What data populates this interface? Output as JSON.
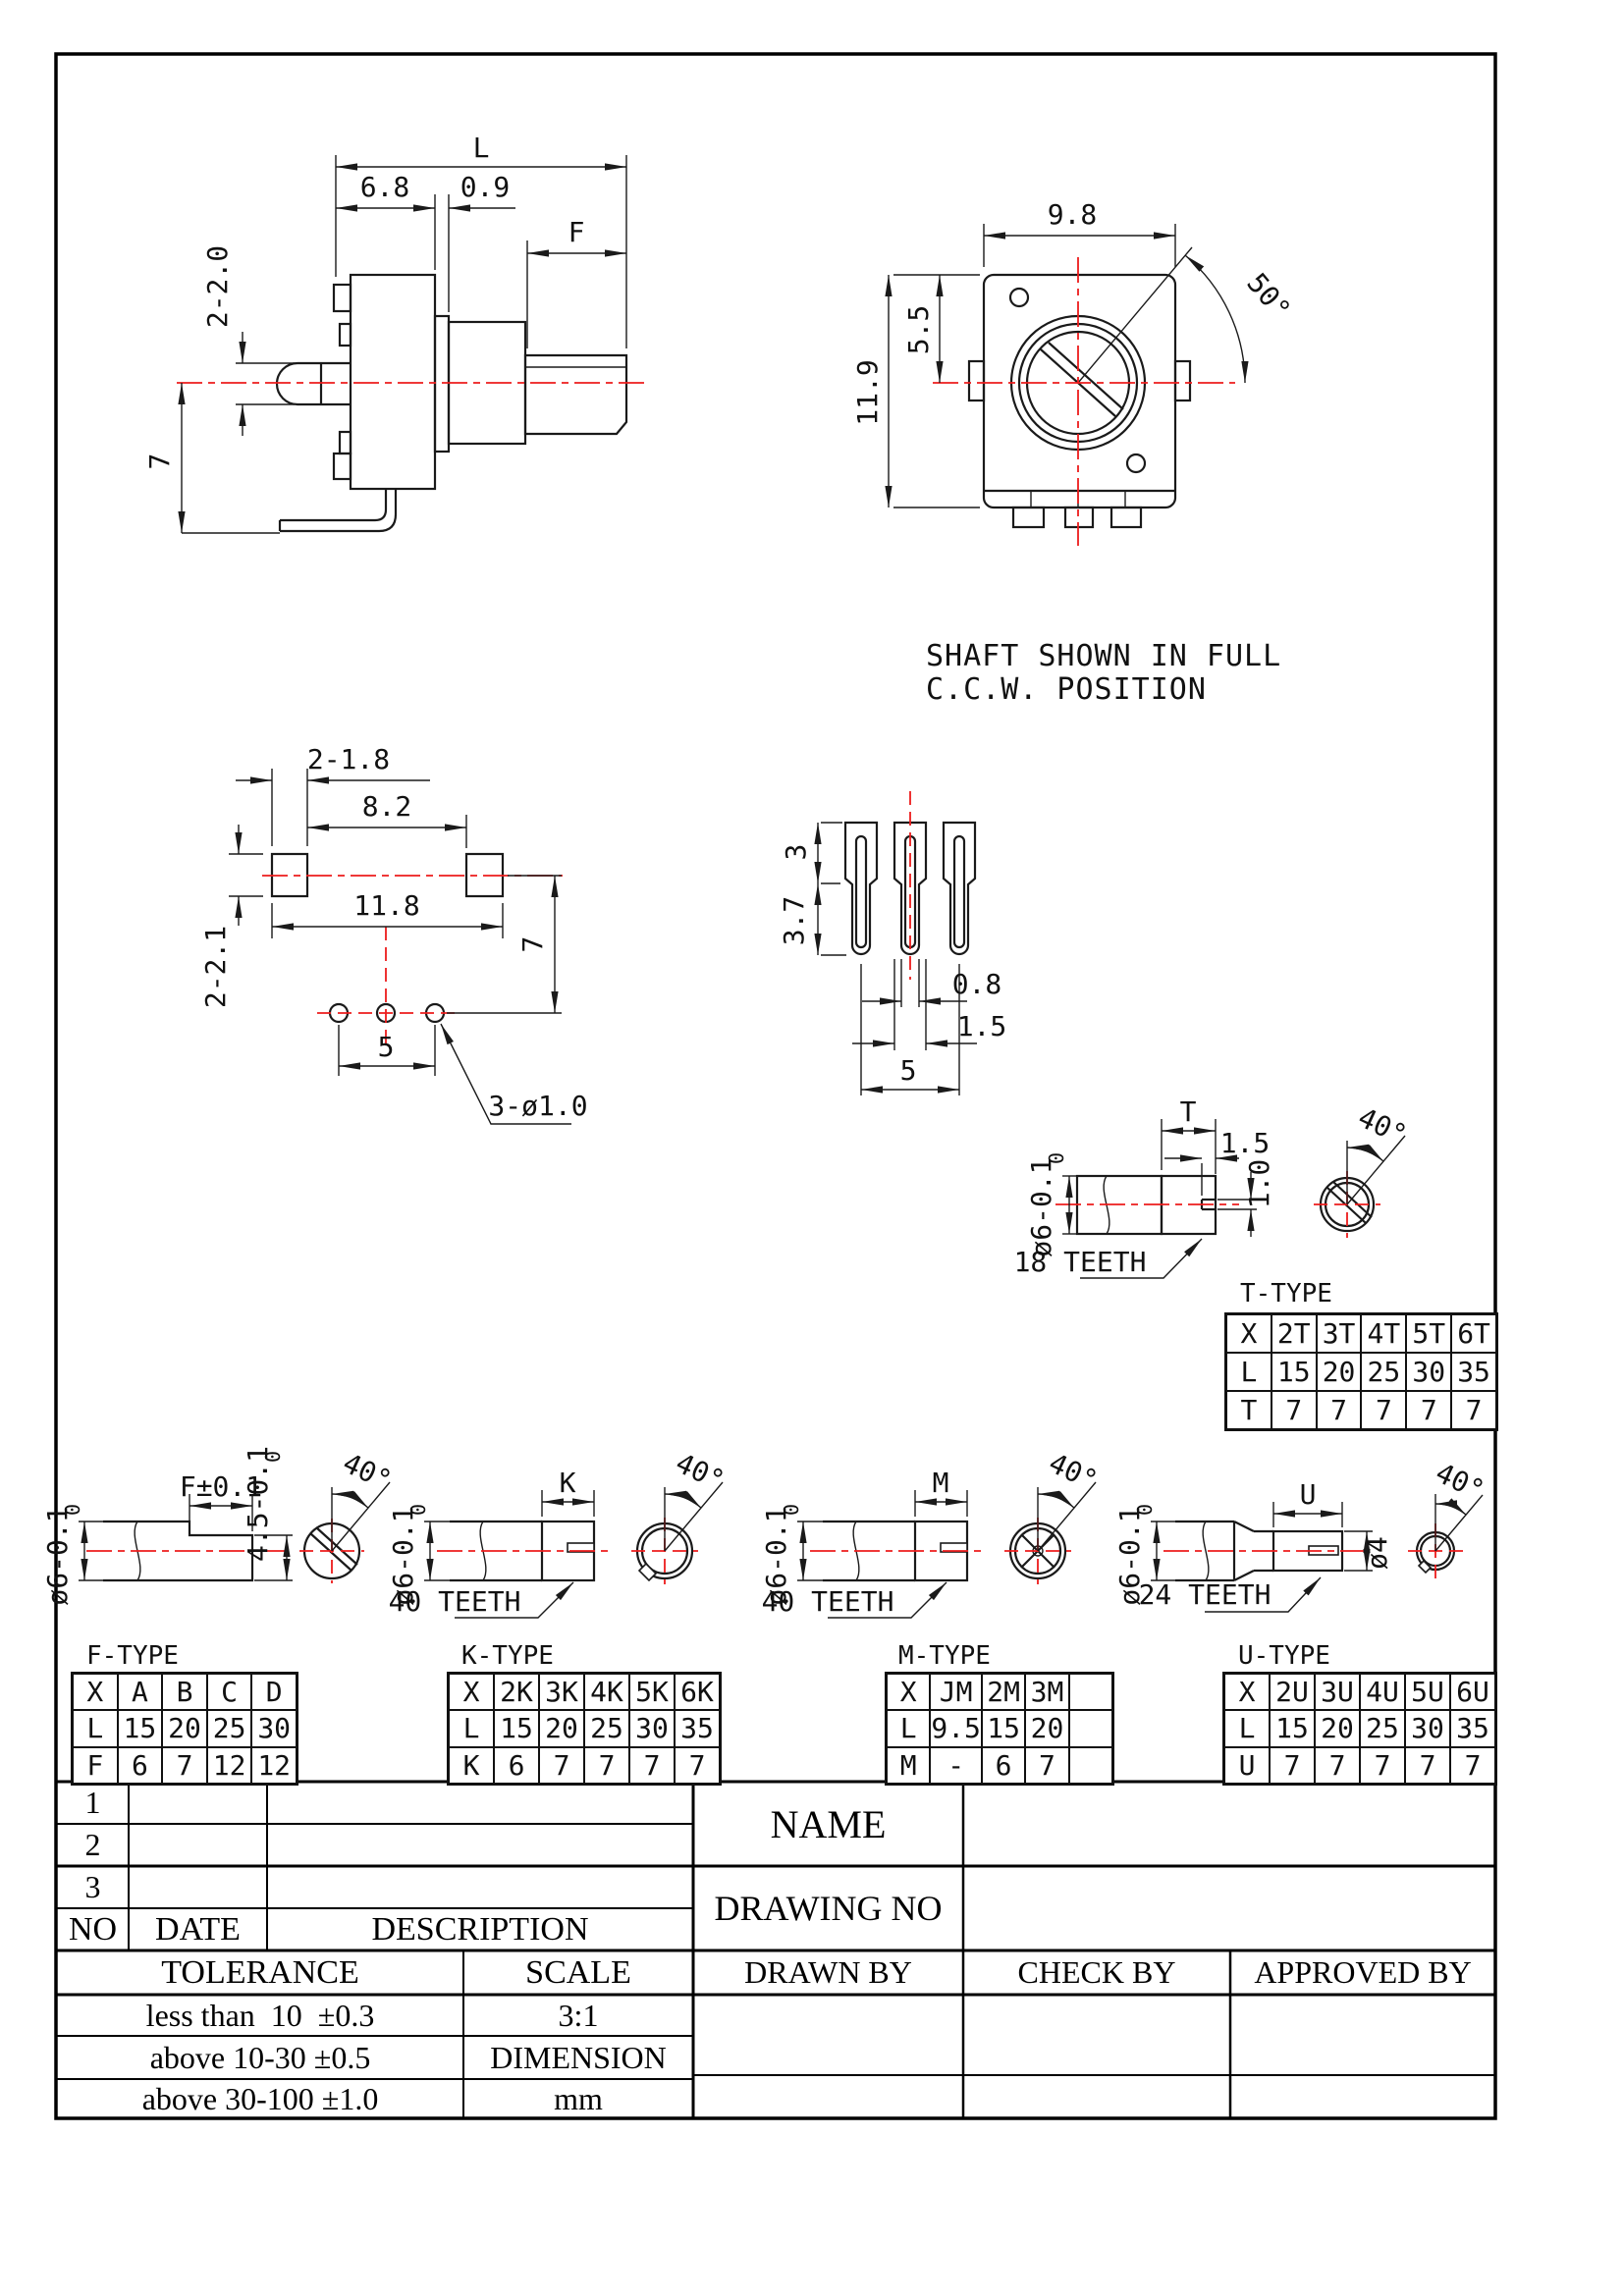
{
  "note": {
    "line1": "SHAFT SHOWN IN FULL",
    "line2": "C.C.W. POSITION"
  },
  "side_view": {
    "l": "L",
    "d68": "6.8",
    "d09": "0.9",
    "f": "F",
    "d220": "2-2.0",
    "d7": "7"
  },
  "front_view": {
    "d98": "9.8",
    "d55": "5.5",
    "d119": "11.9",
    "a50": "50°"
  },
  "bottom_view": {
    "d218": "2-1.8",
    "d82": "8.2",
    "d118": "11.8",
    "d221": "2-2.1",
    "d7": "7",
    "d5": "5",
    "leader": "3-ø1.0"
  },
  "pin_view": {
    "d3": "3",
    "d37": "3.7",
    "d08": "0.8",
    "d15": "1.5",
    "d5": "5"
  },
  "t_shaft": {
    "t": "T",
    "d15": "1.5",
    "d10": "1.0",
    "dia": "ø6-0.1",
    "tol_top": "0",
    "teeth": "18 TEETH",
    "a40": "40°"
  },
  "f_shaft": {
    "f": "F±0.1",
    "h": "4.5-0.1",
    "h_tol_top": "0",
    "dia": "ø6-0.1",
    "tol_top": "0",
    "a40": "40°"
  },
  "k_shaft": {
    "k": "K",
    "dia": "ø6-0.1",
    "tol_top": "0",
    "teeth": "40 TEETH",
    "a40": "40°"
  },
  "m_shaft": {
    "m": "M",
    "dia": "ø6-0.1",
    "tol_top": "0",
    "teeth": "40 TEETH",
    "a40": "40°"
  },
  "u_shaft": {
    "u": "U",
    "d4": "ø4",
    "dia": "ø6-0.1",
    "tol_top": "0",
    "teeth": "24 TEETH",
    "a40": "40°"
  },
  "tables": {
    "t": {
      "title": "T-TYPE",
      "rows": [
        [
          "X",
          "2T",
          "3T",
          "4T",
          "5T",
          "6T"
        ],
        [
          "L",
          "15",
          "20",
          "25",
          "30",
          "35"
        ],
        [
          "T",
          "7",
          "7",
          "7",
          "7",
          "7"
        ]
      ]
    },
    "f": {
      "title": "F-TYPE",
      "rows": [
        [
          "X",
          "A",
          "B",
          "C",
          "D"
        ],
        [
          "L",
          "15",
          "20",
          "25",
          "30"
        ],
        [
          "F",
          "6",
          "7",
          "12",
          "12"
        ]
      ]
    },
    "k": {
      "title": "K-TYPE",
      "rows": [
        [
          "X",
          "2K",
          "3K",
          "4K",
          "5K",
          "6K"
        ],
        [
          "L",
          "15",
          "20",
          "25",
          "30",
          "35"
        ],
        [
          "K",
          "6",
          "7",
          "7",
          "7",
          "7"
        ]
      ]
    },
    "m": {
      "title": "M-TYPE",
      "rows": [
        [
          "X",
          "JM",
          "2M",
          "3M",
          ""
        ],
        [
          "L",
          "9.5",
          "15",
          "20",
          ""
        ],
        [
          "M",
          "-",
          "6",
          "7",
          ""
        ]
      ]
    },
    "u": {
      "title": "U-TYPE",
      "rows": [
        [
          "X",
          "2U",
          "3U",
          "4U",
          "5U",
          "6U"
        ],
        [
          "L",
          "15",
          "20",
          "25",
          "30",
          "35"
        ],
        [
          "U",
          "7",
          "7",
          "7",
          "7",
          "7"
        ]
      ]
    }
  },
  "title_block": {
    "rows": [
      {
        "no": "1"
      },
      {
        "no": "2"
      },
      {
        "no": "3"
      }
    ],
    "no": "NO",
    "date": "DATE",
    "description": "DESCRIPTION",
    "name": "NAME",
    "drawing_no": "DRAWING NO",
    "drawn_by": "DRAWN BY",
    "check_by": "CHECK BY",
    "approved_by": "APPROVED BY",
    "tolerance": "TOLERANCE",
    "scale": "SCALE",
    "scale_value": "3:1",
    "dimension": "DIMENSION",
    "unit": "mm",
    "tol_rows": [
      "less than  10  ±0.3",
      "above 10-30 ±0.5",
      "above 30-100 ±1.0"
    ]
  },
  "colors": {
    "line": "#1a1a1a",
    "centerline": "#ed1c1c"
  }
}
